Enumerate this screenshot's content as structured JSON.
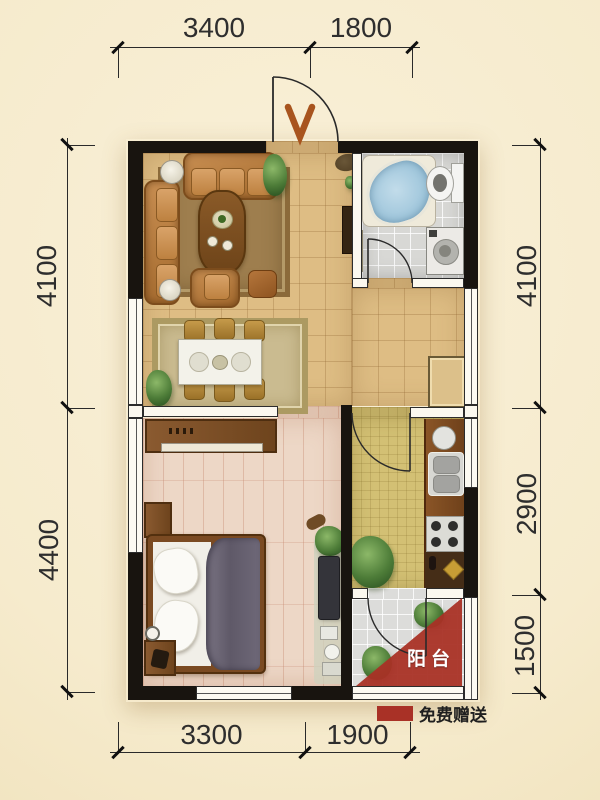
{
  "dimensions": {
    "top": [
      {
        "label": "3400"
      },
      {
        "label": "1800"
      }
    ],
    "bottom": [
      {
        "label": "3300"
      },
      {
        "label": "1900"
      }
    ],
    "left": [
      {
        "label": "4100"
      },
      {
        "label": "4400"
      }
    ],
    "right": [
      {
        "label": "4100"
      },
      {
        "label": "2900"
      },
      {
        "label": "1500"
      }
    ]
  },
  "balcony": {
    "label": "阳台",
    "fill": "#a93126"
  },
  "legend": {
    "label": "免费赠送",
    "swatch": "#a93126"
  },
  "palette": {
    "background": "#f6ebcd",
    "wall": "#18140f",
    "living_floor": "#debd84",
    "bedroom_floor": "#edd7c6",
    "kitchen_floor": "#d3c074",
    "bathroom_floor": "#d8d8d5",
    "balcony_floor": "#dcdcda",
    "dimension_text": "#2e2e2e",
    "accent_red": "#a93126"
  }
}
